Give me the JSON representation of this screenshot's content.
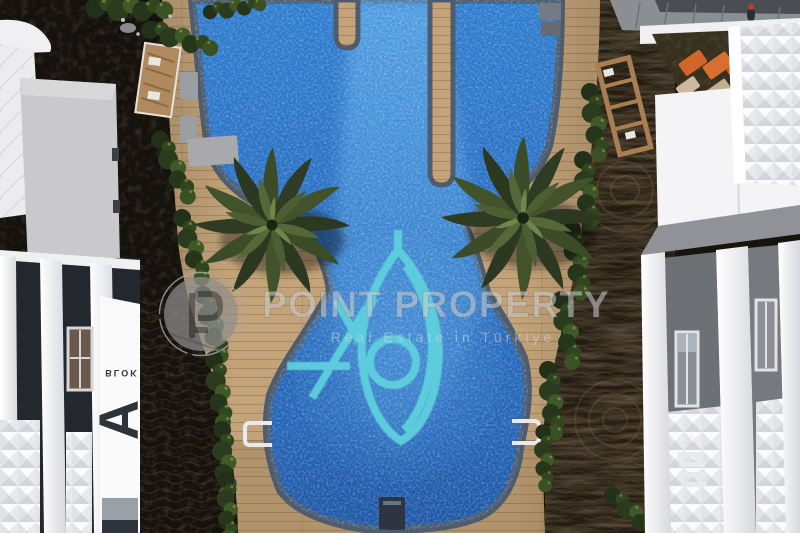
{
  "scene": {
    "type": "aerial-3d-architectural-render",
    "subject": "Residential complex courtyard with a mosaic swimming pool, wooden sun deck, two palm trees and white apartment blocks"
  },
  "watermark": {
    "brand": "POINT PROPERTY",
    "tagline": "Real Estate in Türkiye",
    "logo_icon": "point-property-p-monogram"
  },
  "labels": {
    "left_block_small": "BLOK",
    "left_block_letter": "A",
    "right_block_small": "BLOK"
  },
  "palette": {
    "pool_blue": "#2e76c6",
    "pool_blue_deep": "#1d55a4",
    "pool_blue_light": "#57a3e6",
    "pool_mosaic_accent": "#5fd2de",
    "pool_coping": "#4e5c6e",
    "deck_tan": "#c3a379",
    "palm_green": "#3d4d28",
    "hedge_green": "#2f441f",
    "soil_dark": "#241c12",
    "bed_dark": "#17130d",
    "building_white": "#f2f2f4",
    "facade_gray": "#6d7075",
    "lounger_orange": "#d4652a",
    "watermark_gray": "#b9b9b9"
  }
}
